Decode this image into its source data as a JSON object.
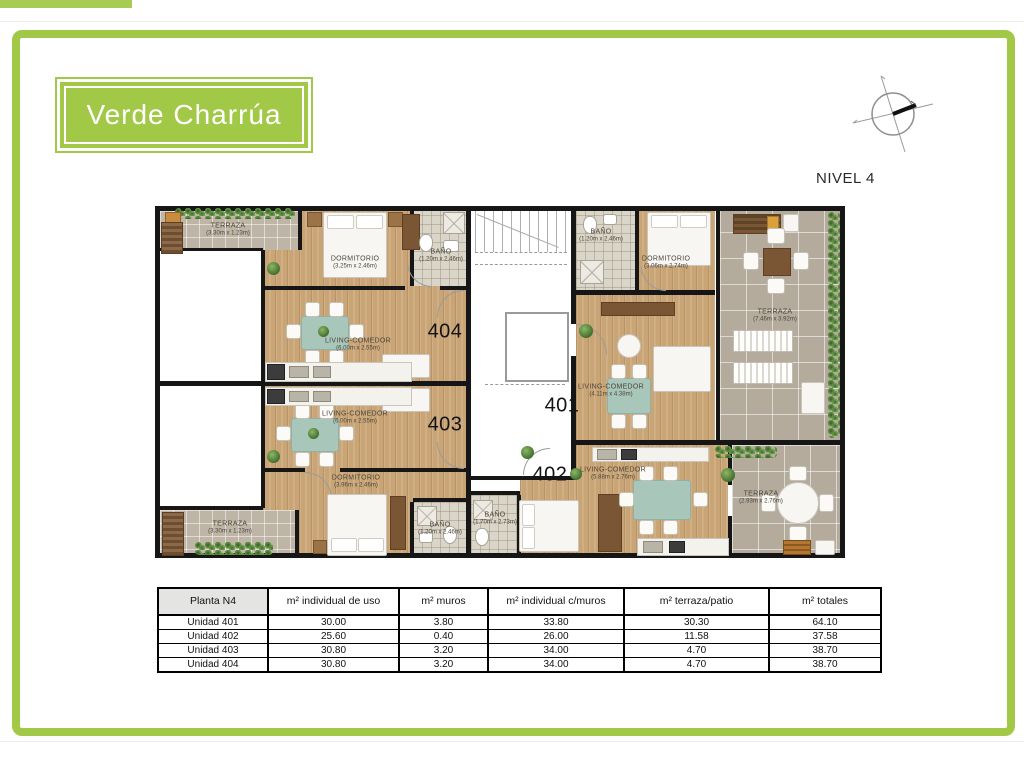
{
  "brand": {
    "logo_text": "Verde Charrúa"
  },
  "header": {
    "level_label": "NIVEL 4"
  },
  "plan": {
    "units": {
      "u401": {
        "number": "401"
      },
      "u402": {
        "number": "402"
      },
      "u403": {
        "number": "403"
      },
      "u404": {
        "number": "404"
      }
    },
    "rooms": {
      "terraza_404": {
        "name": "TERRAZA",
        "dims": "(3.30m x 1.23m)"
      },
      "dormitorio_404": {
        "name": "DORMITORIO",
        "dims": "(3.25m x 2.46m)"
      },
      "bano_404": {
        "name": "BAÑO",
        "dims": "(1.20m x 2.46m)"
      },
      "living_404": {
        "name": "LIVING-COMEDOR",
        "dims": "(6.00m x 2.55m)"
      },
      "bano_401": {
        "name": "BAÑO",
        "dims": "(1.20m x 2.46m)"
      },
      "dormitorio_401": {
        "name": "DORMITORIO",
        "dims": "(3.06m x 2.74m)"
      },
      "living_401": {
        "name": "LIVING-COMEDOR",
        "dims": "(4.11m x 4.38m)"
      },
      "terraza_401": {
        "name": "TERRAZA",
        "dims": "(7.46m x 3.92m)"
      },
      "living_403": {
        "name": "LIVING-COMEDOR",
        "dims": "(6.00m x 2.55m)"
      },
      "dormitorio_403": {
        "name": "DORMITORIO",
        "dims": "(3.96m x 2.46m)"
      },
      "terraza_403": {
        "name": "TERRAZA",
        "dims": "(3.30m x 1.23m)"
      },
      "bano_403": {
        "name": "BAÑO",
        "dims": "(1.20m x 2.46m)"
      },
      "bano_402": {
        "name": "BAÑO",
        "dims": "(1.70m x 2.73m)"
      },
      "living_402": {
        "name": "LIVING-COMEDOR",
        "dims": "(5.88m x 2.76m)"
      },
      "terraza_402": {
        "name": "TERRAZA",
        "dims": "(2.93m x 2.76m)"
      }
    }
  },
  "table": {
    "headers": [
      "Planta N4",
      "m² individual de uso",
      "m² muros",
      "m² individual c/muros",
      "m² terraza/patio",
      "m² totales"
    ],
    "rows": [
      [
        "Unidad 401",
        "30.00",
        "3.80",
        "33.80",
        "30.30",
        "64.10"
      ],
      [
        "Unidad 402",
        "25.60",
        "0.40",
        "26.00",
        "11.58",
        "37.58"
      ],
      [
        "Unidad 403",
        "30.80",
        "3.20",
        "34.00",
        "4.70",
        "38.70"
      ],
      [
        "Unidad 404",
        "30.80",
        "3.20",
        "34.00",
        "4.70",
        "38.70"
      ]
    ]
  },
  "colors": {
    "brand_green": "#a2c847",
    "wall_black": "#161616",
    "wood_floor": "#c9a475",
    "terrace_tile": "#b4ab9d",
    "bath_tile": "#dad5c9"
  }
}
